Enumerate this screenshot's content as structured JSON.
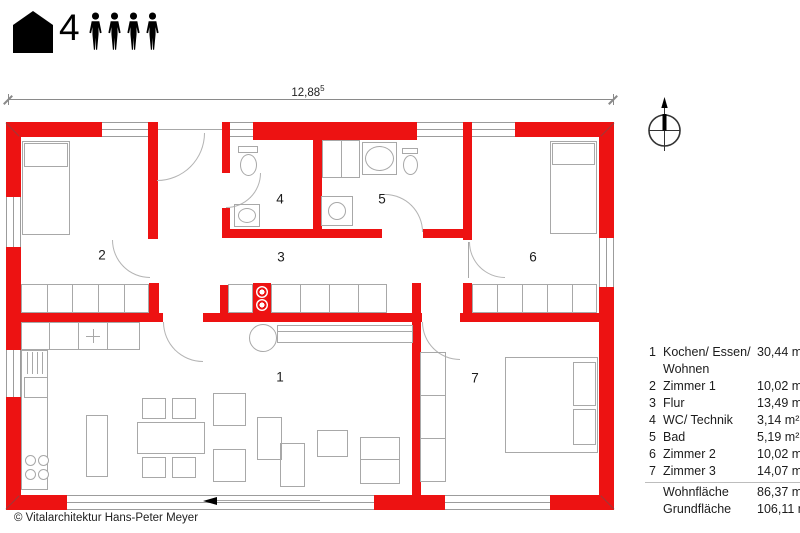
{
  "header": {
    "occupants_count": "4",
    "icons": {
      "house": "house-icon",
      "person": "person-icon"
    }
  },
  "dimension": {
    "value": "12,88",
    "sup": "5"
  },
  "compass": {
    "icon": "north-compass-icon"
  },
  "plan": {
    "rooms": [
      {
        "num": "1"
      },
      {
        "num": "2"
      },
      {
        "num": "3"
      },
      {
        "num": "4"
      },
      {
        "num": "5"
      },
      {
        "num": "6"
      },
      {
        "num": "7"
      }
    ]
  },
  "legend": {
    "rows": [
      {
        "num": "1",
        "label": "Kochen/ Essen/ Wohnen",
        "value": "30,44 m²"
      },
      {
        "num": "2",
        "label": "Zimmer 1",
        "value": "10,02 m²"
      },
      {
        "num": "3",
        "label": "Flur",
        "value": "13,49 m²"
      },
      {
        "num": "4",
        "label": "WC/ Technik",
        "value": "3,14 m²"
      },
      {
        "num": "5",
        "label": "Bad",
        "value": "5,19 m²"
      },
      {
        "num": "6",
        "label": "Zimmer 2",
        "value": "10,02 m²"
      },
      {
        "num": "7",
        "label": "Zimmer 3",
        "value": "14,07 m²"
      },
      {
        "num": "",
        "label": "Wohnfläche",
        "value": "86,37 m²"
      },
      {
        "num": "",
        "label": "Grundfläche",
        "value": "106,11 m²"
      }
    ]
  },
  "footer": {
    "copyright": "© Vitalarchitektur Hans-Peter Meyer"
  },
  "colors": {
    "wall_red": "#ed1212",
    "furniture_line": "#a8a8a8",
    "text": "#1c1c1c"
  }
}
